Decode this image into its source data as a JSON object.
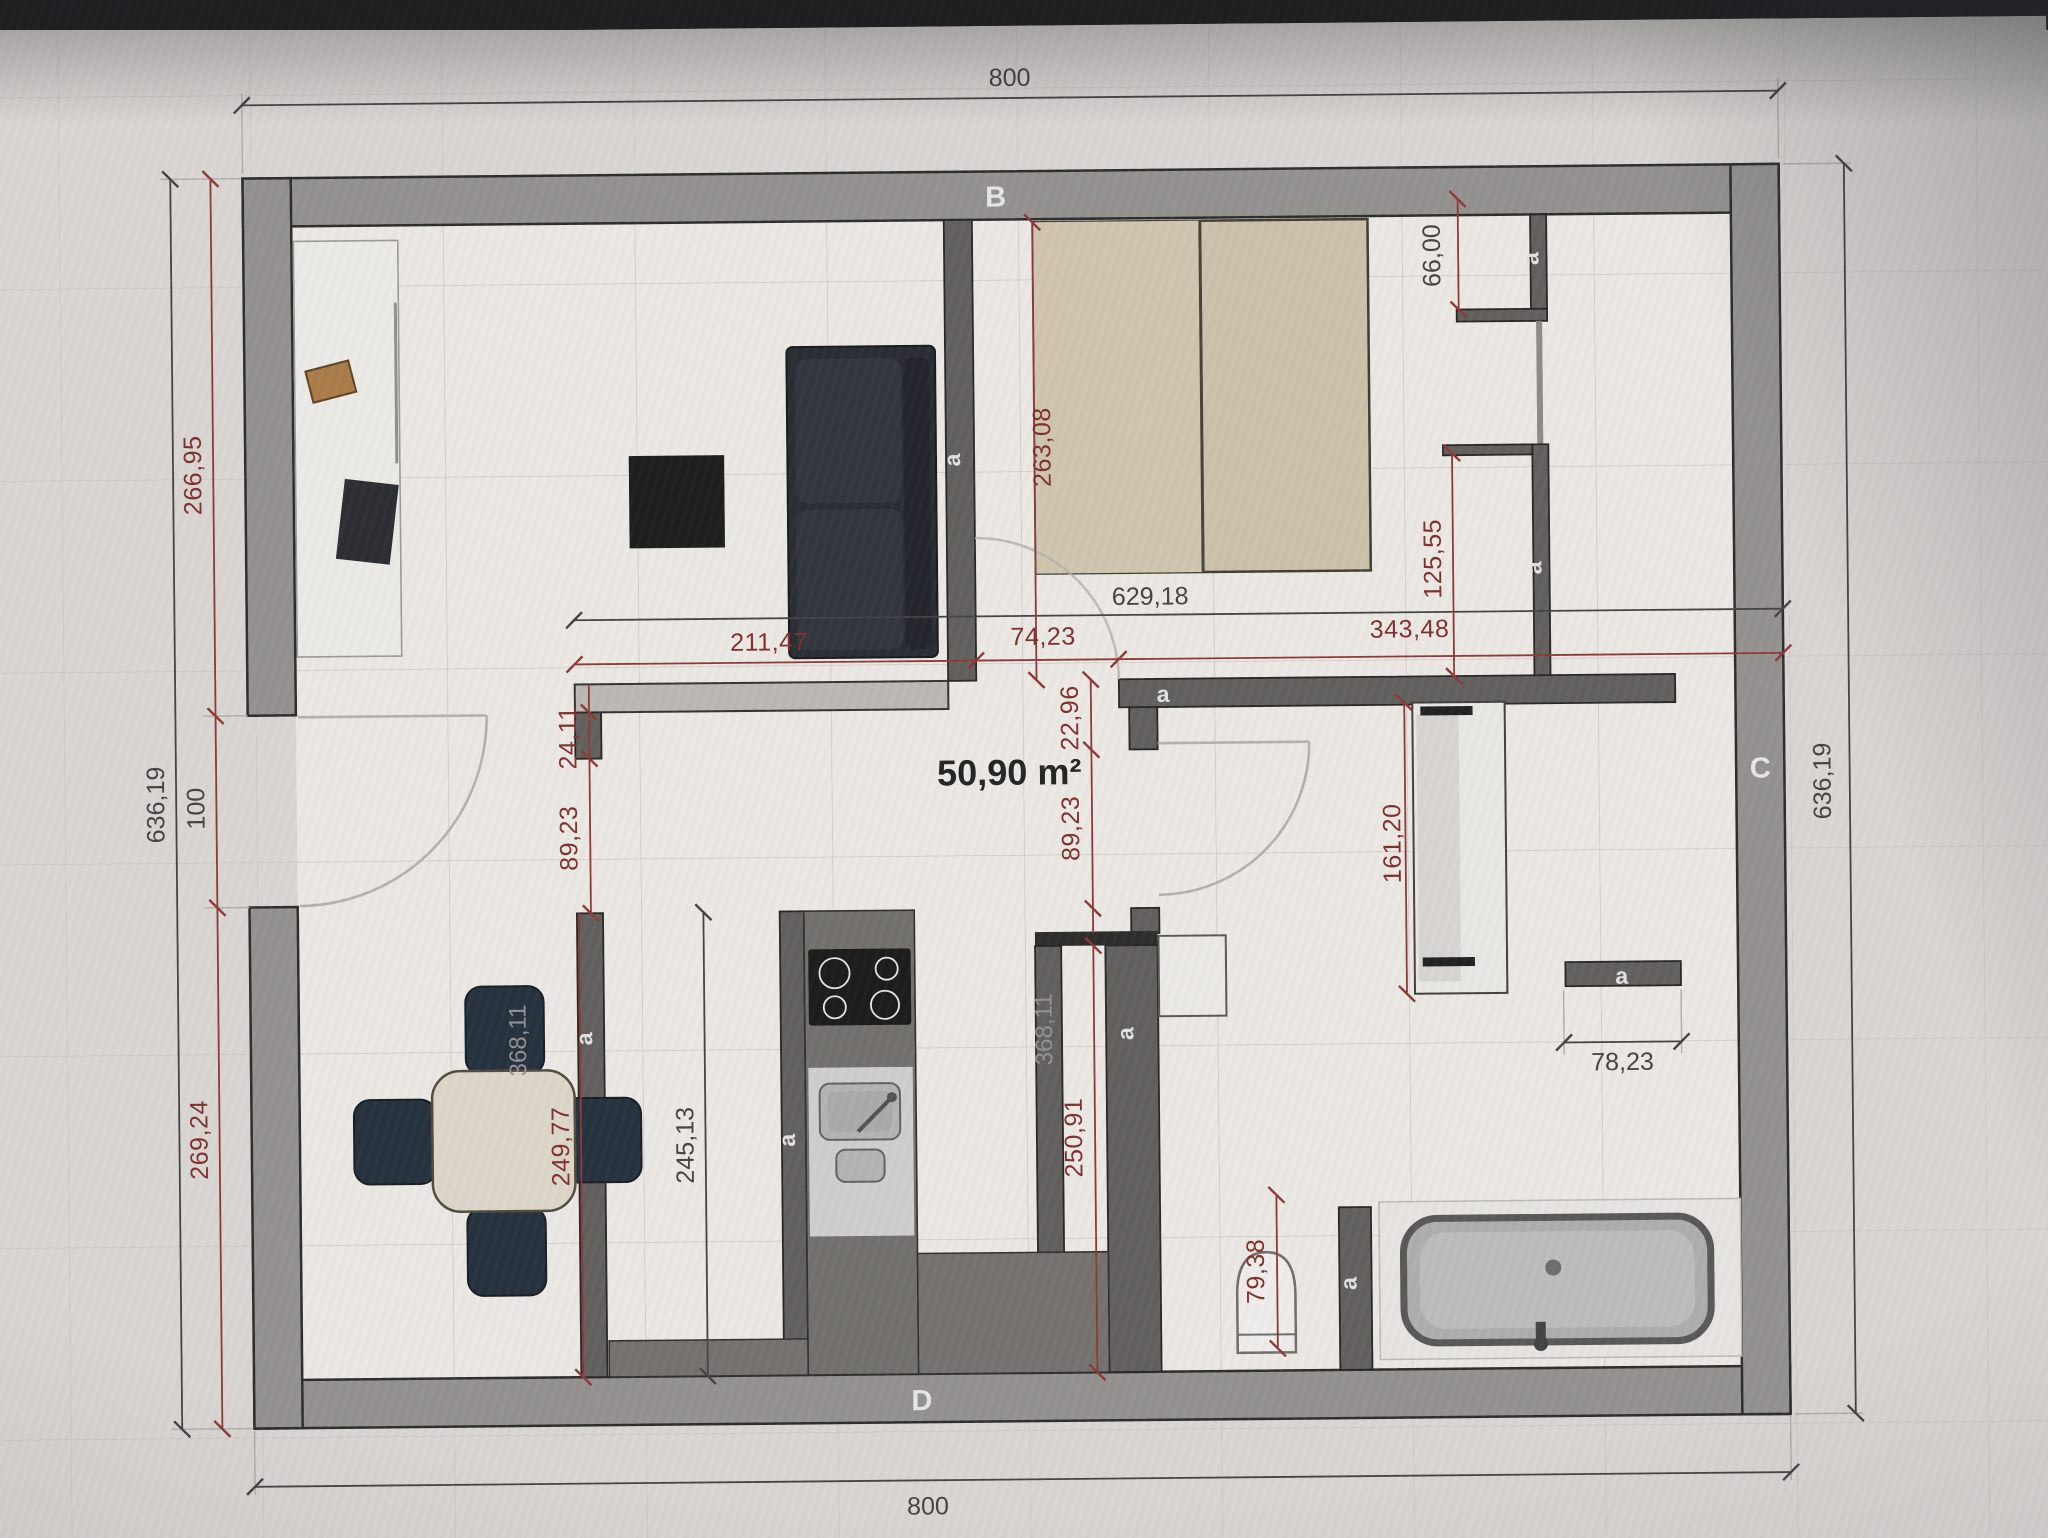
{
  "plan": {
    "area_label": "50,90 m²",
    "wall_letters": {
      "top": "B",
      "right": "C",
      "bottom": "D"
    },
    "wall_tag": "a",
    "dims": {
      "top_total": "800",
      "bottom_total": "800",
      "left_total": "636,19",
      "right_total": "636,19",
      "left_upper": "266,95",
      "left_door": "100",
      "left_lower": "269,24",
      "mid_total": "629,18",
      "mid_left": "211,47",
      "mid_door": "74,23",
      "mid_right": "343,48",
      "bed_depth": "263,08",
      "closet_opening": "66,00",
      "closet_lower": "125,55",
      "entry_stub": "24,11",
      "entry_opening": "89,23",
      "hall_stub": "22,96",
      "hall_door": "89,23",
      "kitchen_length": "245,13",
      "dining_length": "249,77",
      "hall_length": "250,91",
      "island_left": "368,11",
      "island_right": "368,11",
      "wardrobe_length": "161,20",
      "bath_nook": "78,23",
      "toilet_width": "79,38"
    },
    "colors": {
      "dim_red": "#7c2a28",
      "dim_dark": "#3f3e3c",
      "wall_gray": "#918f8c",
      "floor": "#f0eee9",
      "bed_beige": "#cbc1a9",
      "chair_navy": "#1f2b38"
    }
  }
}
